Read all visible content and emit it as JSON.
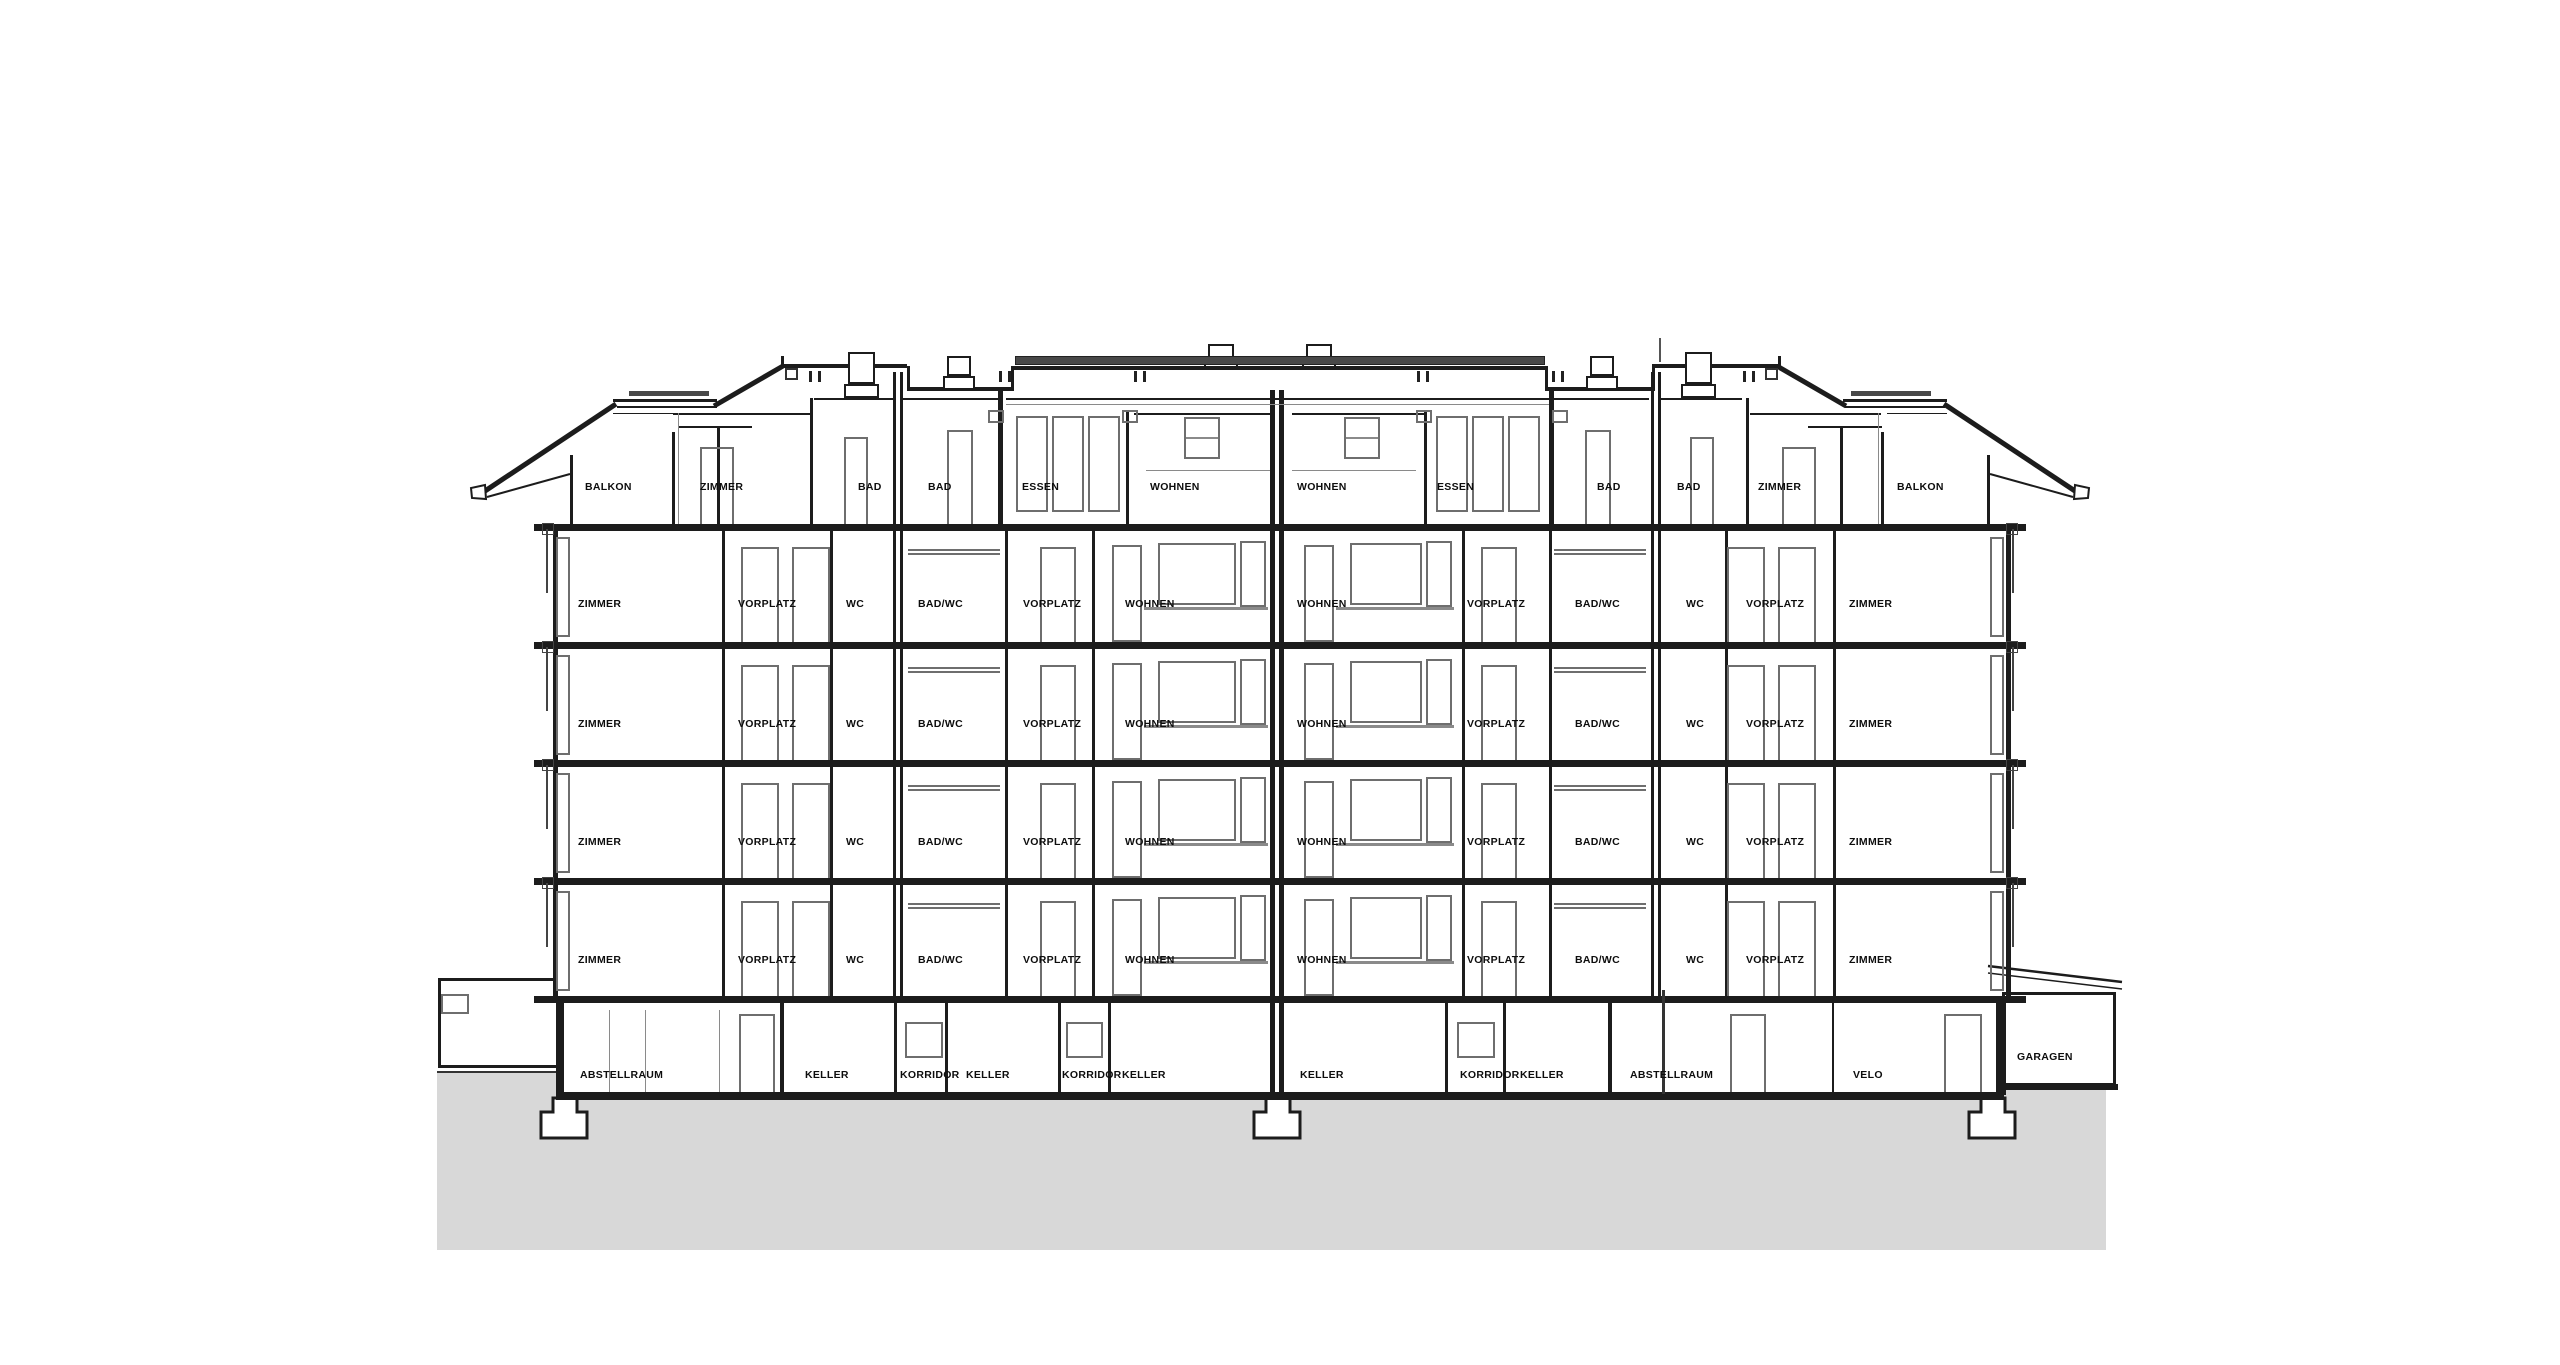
{
  "drawing": {
    "type": "building-cross-section",
    "floors": [
      {
        "name": "attic",
        "rooms": [
          "BALKON",
          "ZIMMER",
          "BAD",
          "BAD",
          "ESSEN",
          "WOHNEN",
          "WOHNEN",
          "ESSEN",
          "BAD",
          "BAD",
          "ZIMMER",
          "BALKON"
        ]
      },
      {
        "name": "upper-floor-4",
        "rooms": [
          "ZIMMER",
          "VORPLATZ",
          "WC",
          "BAD/WC",
          "VORPLATZ",
          "WOHNEN",
          "WOHNEN",
          "VORPLATZ",
          "BAD/WC",
          "WC",
          "VORPLATZ",
          "ZIMMER"
        ]
      },
      {
        "name": "upper-floor-3",
        "rooms": [
          "ZIMMER",
          "VORPLATZ",
          "WC",
          "BAD/WC",
          "VORPLATZ",
          "WOHNEN",
          "WOHNEN",
          "VORPLATZ",
          "BAD/WC",
          "WC",
          "VORPLATZ",
          "ZIMMER"
        ]
      },
      {
        "name": "upper-floor-2",
        "rooms": [
          "ZIMMER",
          "VORPLATZ",
          "WC",
          "BAD/WC",
          "VORPLATZ",
          "WOHNEN",
          "WOHNEN",
          "VORPLATZ",
          "BAD/WC",
          "WC",
          "VORPLATZ",
          "ZIMMER"
        ]
      },
      {
        "name": "upper-floor-1",
        "rooms": [
          "ZIMMER",
          "VORPLATZ",
          "WC",
          "BAD/WC",
          "VORPLATZ",
          "WOHNEN",
          "WOHNEN",
          "VORPLATZ",
          "BAD/WC",
          "WC",
          "VORPLATZ",
          "ZIMMER"
        ]
      },
      {
        "name": "basement",
        "rooms": [
          "ABSTELLRAUM",
          "KELLER",
          "KORRIDOR",
          "KELLER",
          "KORRIDOR",
          "KELLER",
          "KELLER",
          "KORRIDOR",
          "KELLER",
          "ABSTELLRAUM",
          "VELO",
          "GARAGEN"
        ]
      }
    ],
    "colors": {
      "line": "#1c1c1c",
      "window_frame": "#6e6e6e",
      "ground": "#d8d8d8",
      "solar_strip": "#484848"
    }
  }
}
